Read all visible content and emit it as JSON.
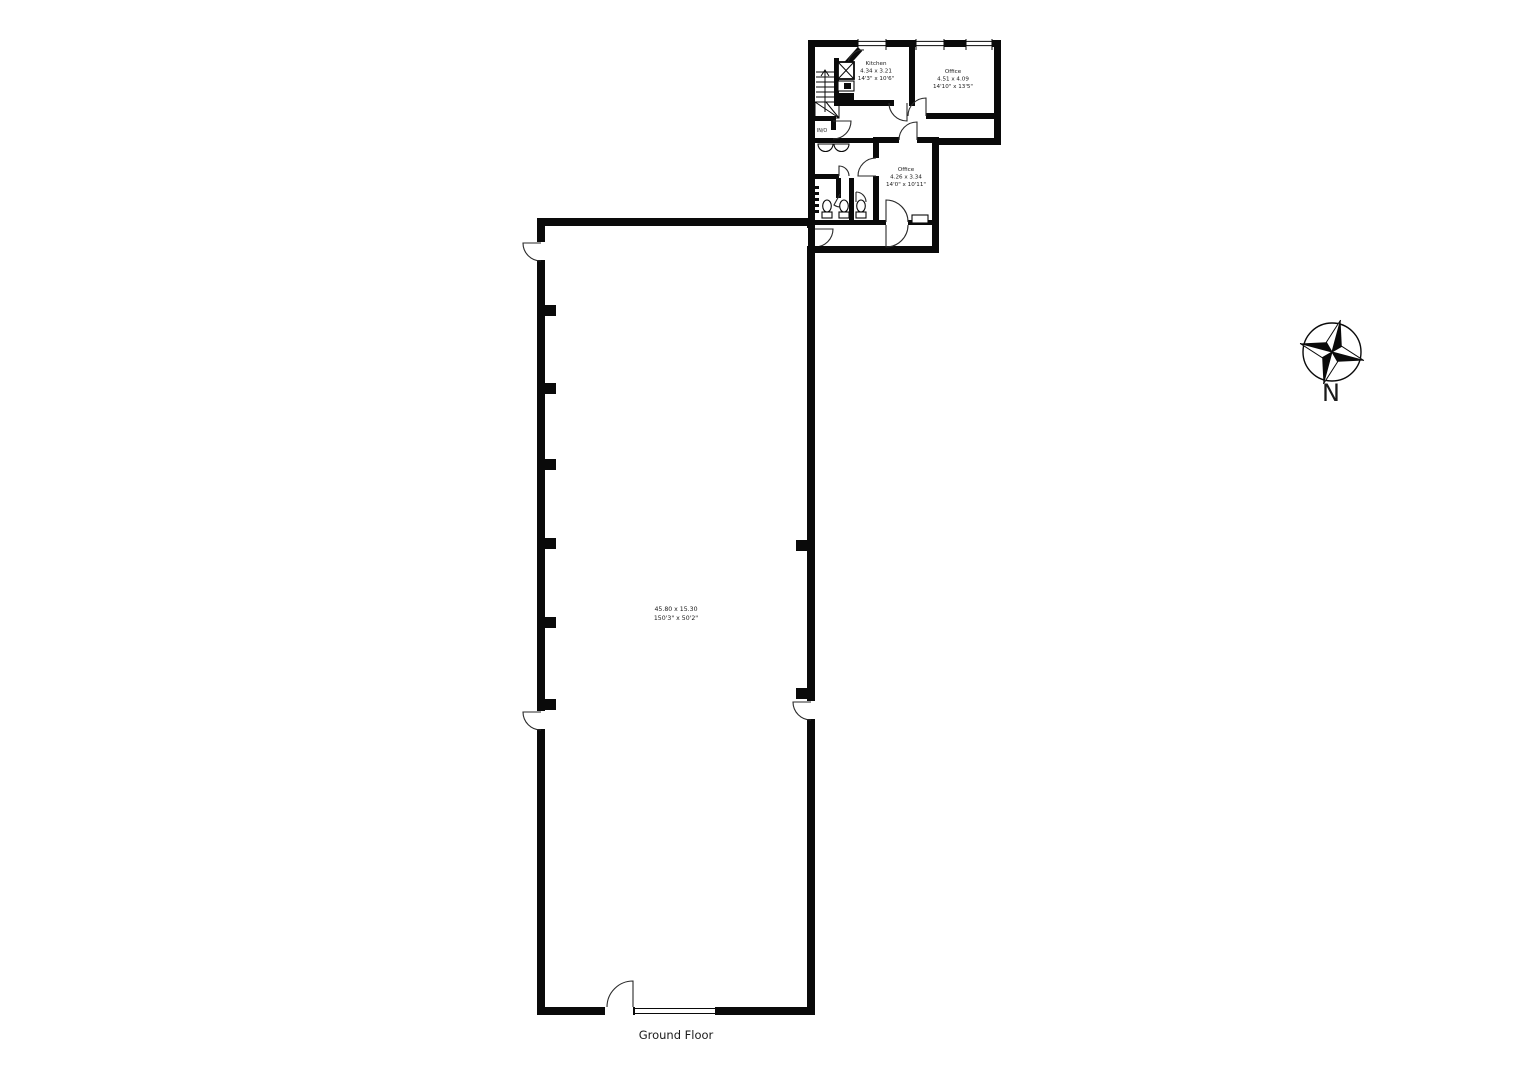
{
  "floor_label": "Ground Floor",
  "compass": {
    "label": "N"
  },
  "rooms": {
    "main_hall": {
      "metric": "45.80 x 15.30",
      "imperial": "150'3\" x 50'2\""
    },
    "kitchen": {
      "name": "Kitchen",
      "metric": "4.34 x 3.21",
      "imperial": "14'3\" x 10'6\""
    },
    "office_rear": {
      "name": "Office",
      "metric": "4.51 x 4.09",
      "imperial": "14'10\" x 13'5\""
    },
    "office_front": {
      "name": "Office",
      "metric": "4.26 x 3.34",
      "imperial": "14'0\" x 10'11\""
    },
    "lobby": {
      "name": "IN/O"
    }
  },
  "colors": {
    "wall": "#0a0a0a",
    "background": "#ffffff",
    "door_arc": "#2a2a2a"
  }
}
